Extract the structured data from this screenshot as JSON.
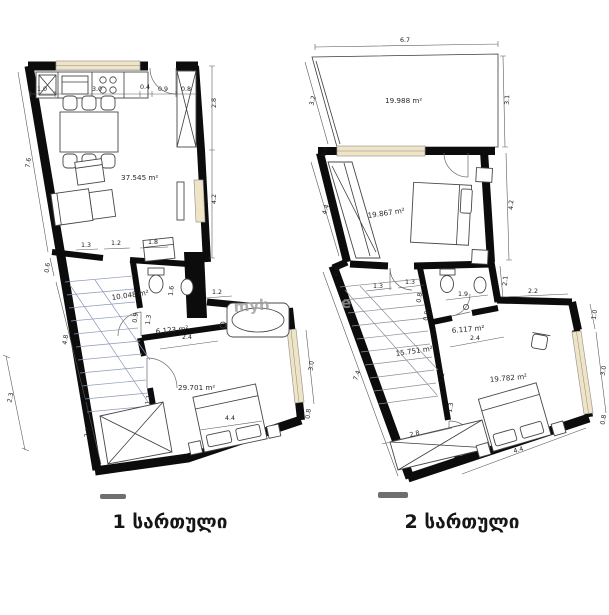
{
  "plans": {
    "plan1": {
      "floor_label": "1 სართული",
      "rooms": {
        "living": "37.545 m²",
        "hall": "10.048 m²",
        "bath": "6.123 m²",
        "bedroom": "29.701 m²"
      },
      "dims": {
        "top1": "1.0",
        "top2": "3.0",
        "top3": "0.4",
        "top4": "0.9",
        "top5": "0.8",
        "right1": "2.8",
        "right2": "4.2",
        "left1": "7.6",
        "left2": "0.6",
        "left3": "4.8",
        "left4": "2.5",
        "farleft": "2.3",
        "row1": "1.3",
        "row2": "1.2",
        "row3": "1.8",
        "bath1": "0.9",
        "bath2": "1.2",
        "bath3": "1.6",
        "bath4": "2.4",
        "bath5": "1.3",
        "bed1": "1.1",
        "bed2": "4.4",
        "win1": "3.0",
        "win2": "0.8"
      }
    },
    "plan2": {
      "floor_label": "2 სართული",
      "rooms": {
        "terrace": "19.988 m²",
        "bedroom1": "19.867 m²",
        "hall": "15.751 m²",
        "bath": "6.117 m²",
        "bedroom2": "19.782 m²"
      },
      "dims": {
        "top": "6.7",
        "right1": "3.1",
        "right2": "4.2",
        "right3": "1.0",
        "right4": "3.0",
        "right5": "0.8",
        "left1": "3.2",
        "left2": "0.4",
        "left3": "4.4",
        "left4": "0.8",
        "left5": "7.4",
        "bottom1": "2.8",
        "bottom2": "4.4",
        "stair1": "1.3",
        "stair2": "1.3",
        "bath1": "1.9",
        "bath2": "2.1",
        "bath3": "2.4",
        "bath4": "0.9",
        "bath5": "2.2",
        "wall1": "0.8",
        "wall2": "1.2",
        "wall3": "1.3"
      }
    }
  },
  "watermark": {
    "part1": "myh",
    "part2": "e"
  }
}
